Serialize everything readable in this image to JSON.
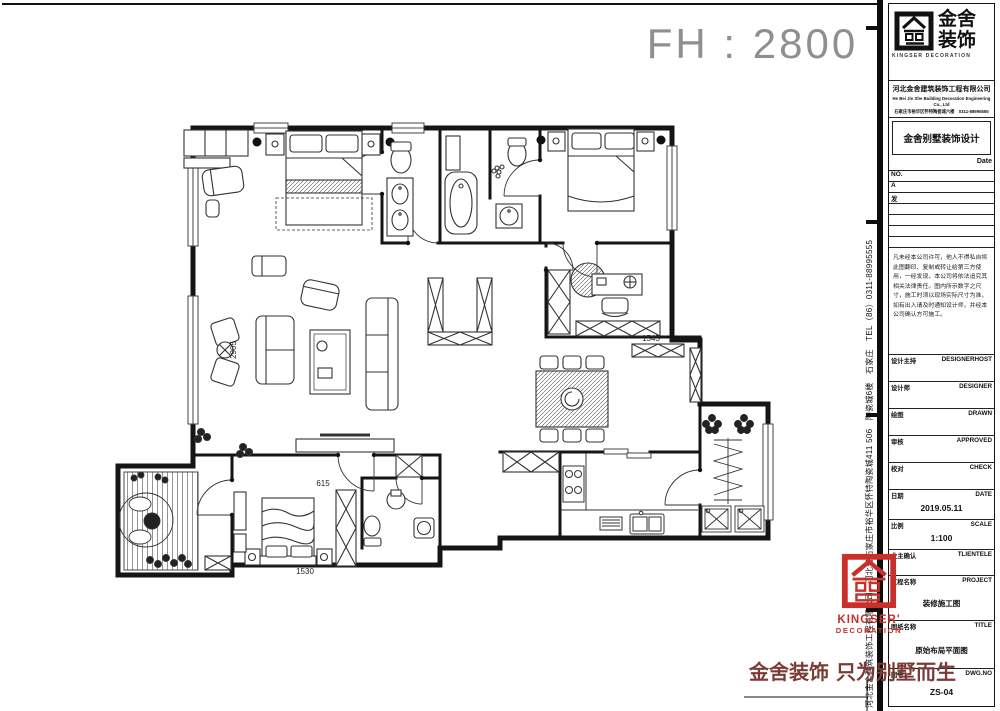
{
  "header": {
    "fh_label": "FH : 2800"
  },
  "plan": {
    "dims": {
      "d1": "2905",
      "d2": "1545",
      "d3": "615",
      "d4": "1530"
    }
  },
  "edge": {
    "vertical_text": "河北金舍建筑装饰工程有限公司，河北省石家庄市裕华区怀特陶瓷城411 506　陶瓷城6楼　石家庄　TEL（86）0311-88995555"
  },
  "titleblock": {
    "brand_cn_1": "金舍",
    "brand_cn_2": "装饰",
    "brand_en_1": "KINGSER",
    "brand_en_2": "DECORATION",
    "company_cn": "河北金舍建筑装饰工程有限公司",
    "company_en": "He Bei Jin She Building Decoration Engineering Co., Ltd",
    "company_addr": "石家庄市裕华区怀特陶瓷城六楼　0311-88995555",
    "brand_line": "金舍别墅装饰设计",
    "date_label": "Date",
    "no_label": "NO.",
    "rev_rows": [
      "A",
      "发"
    ],
    "disclaimer": "凡未经本公司许可，他人不得私自将此图翻印、复制或转让给第三方使用，一经发现，本公司将依法追究其相关法律责任。图内所示数字之尺寸，施工时须以现场实际尺寸为准，如有出入请及时通知设计师，并经本公司确认方可施工。",
    "fields": [
      {
        "cn": "设计主持",
        "en": "DESIGNERHOST",
        "value": ""
      },
      {
        "cn": "设计师",
        "en": "DESIGNER",
        "value": ""
      },
      {
        "cn": "绘图",
        "en": "DRAWN",
        "value": ""
      },
      {
        "cn": "审核",
        "en": "APPROVED",
        "value": ""
      },
      {
        "cn": "校对",
        "en": "CHECK",
        "value": ""
      },
      {
        "cn": "日期",
        "en": "DATE",
        "value": "2019.05.11"
      },
      {
        "cn": "比例",
        "en": "SCALE",
        "value": "1:100"
      },
      {
        "cn": "业主确认",
        "en": "TLIENTELE",
        "value": ""
      },
      {
        "cn": "工程名称",
        "en": "PROJECT",
        "value": "装修施工图"
      },
      {
        "cn": "图纸名称",
        "en": "TITLE",
        "value": "原始布局平面图"
      },
      {
        "cn": "图号",
        "en": "DWG.NO",
        "value": "ZS-04"
      }
    ]
  },
  "red_logo": {
    "en_1": "KINGSER'",
    "en_2": "DECORATION"
  },
  "footer": {
    "slogan": "金舍装饰 只为别墅而生"
  },
  "colors": {
    "logo_red": "#c9302c",
    "slogan_red": "#7a3b35",
    "cad_gray": "#8f8f8f"
  }
}
